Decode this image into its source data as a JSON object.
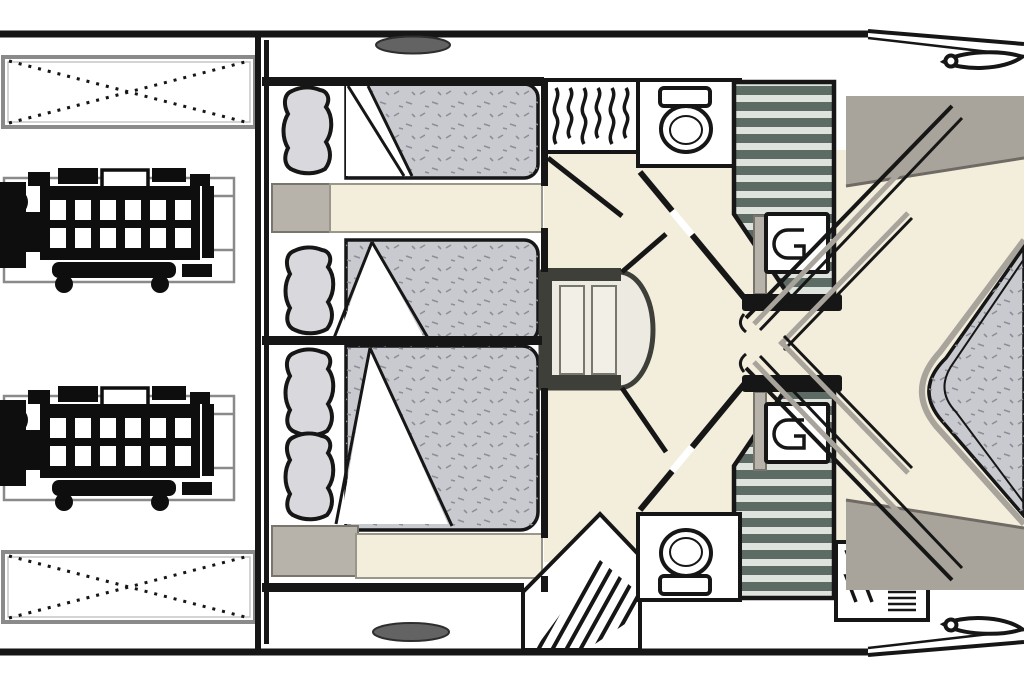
{
  "figure": {
    "type": "floor-plan",
    "subject": "yacht-lower-deck-accommodation-plan",
    "orientation": "bow-right",
    "visible_text": []
  },
  "palette": {
    "wall": "#161616",
    "floor": "#f3eedc",
    "mattress": "#c9cacf",
    "speckle": "#8d8e96",
    "deck": "#a9a49b",
    "furniture": "#b7b3aa",
    "stairLight": "#dfe3dd",
    "stairMid": "#5c6b64",
    "stairDark": "#3f3f3a",
    "tread": "#f1efe6",
    "porthole": "#636363",
    "engine": "#0e0e0e",
    "frame": "#8a8a8a"
  },
  "inventory": {
    "engines": 2,
    "crossed_service_boxes": 2,
    "guest_beds_midship": 3,
    "pillows": 4,
    "vip_bed_bow": 1,
    "toilets": 2,
    "hanging_wardrobes": 3,
    "staircases": 3,
    "vanity_units": 2,
    "portholes": 2,
    "bow_windows": 2
  }
}
